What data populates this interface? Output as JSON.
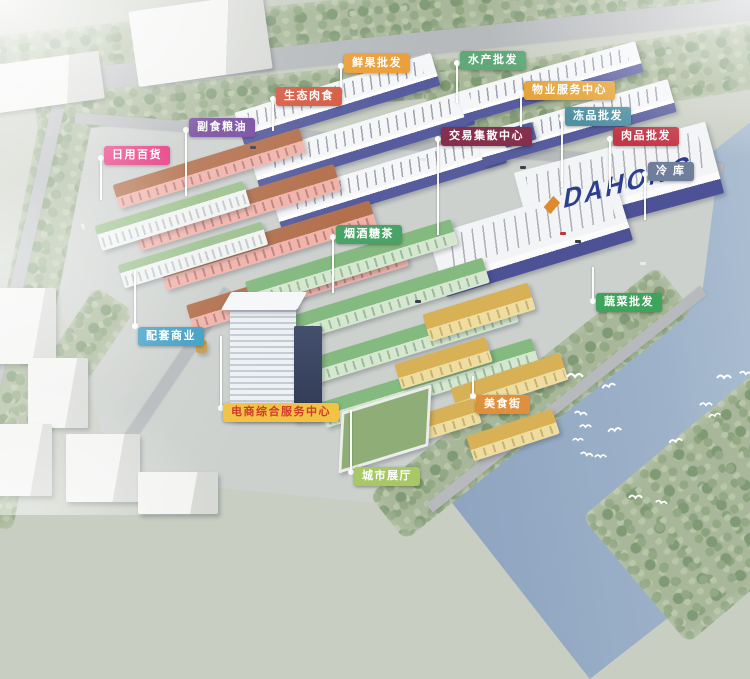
{
  "scene": {
    "type": "aerial-rendering-of-wholesale-market-masterplan",
    "roof_logo": {
      "text": "DAHONG",
      "color": "#2c3e8f",
      "accent": "#e08a2e"
    }
  },
  "labels": [
    {
      "id": "daily-goods",
      "text": "日用百货",
      "bg": "#e6327d",
      "fg": "#ffffff"
    },
    {
      "id": "grain-oil",
      "text": "副食粮油",
      "bg": "#744a9e",
      "fg": "#ffffff"
    },
    {
      "id": "eco-meat",
      "text": "生态肉食",
      "bg": "#d65a42",
      "fg": "#ffffff"
    },
    {
      "id": "fresh-fruit",
      "text": "鲜果批发",
      "bg": "#eb9f3a",
      "fg": "#ffffff"
    },
    {
      "id": "aquatic-wholesale",
      "text": "水产批发",
      "bg": "#5fa877",
      "fg": "#ffffff"
    },
    {
      "id": "trading-center",
      "text": "交易集散中心",
      "bg": "#842f4c",
      "fg": "#ffffff"
    },
    {
      "id": "property-service",
      "text": "物业服务中心",
      "bg": "#e5a53b",
      "fg": "#ffffff"
    },
    {
      "id": "frozen-wholesale",
      "text": "冻品批发",
      "bg": "#4f90a3",
      "fg": "#ffffff"
    },
    {
      "id": "meat-wholesale",
      "text": "肉品批发",
      "bg": "#c23646",
      "fg": "#ffffff"
    },
    {
      "id": "cold-storage",
      "text": "冷  库",
      "bg": "#6f7e9b",
      "fg": "#ffffff"
    },
    {
      "id": "vegetable-wholesale",
      "text": "蔬菜批发",
      "bg": "#3ea45c",
      "fg": "#ffffff"
    },
    {
      "id": "tobacco-liquor-tea",
      "text": "烟酒糖茶",
      "bg": "#4aa366",
      "fg": "#ffffff"
    },
    {
      "id": "supporting-commerce",
      "text": "配套商业",
      "bg": "#3e9fc4",
      "fg": "#ffffff"
    },
    {
      "id": "ecommerce-center",
      "text": "电商综合服务中心",
      "bg": "#f1c244",
      "fg": "#d03a2e"
    },
    {
      "id": "food-street",
      "text": "美食街",
      "bg": "#de903d",
      "fg": "#ffffff"
    },
    {
      "id": "city-exhibition-hall",
      "text": "城市展厅",
      "bg": "#a7c865",
      "fg": "#ffffff"
    }
  ],
  "palette": {
    "river": "#9db2c9",
    "land": "#cdd1ce",
    "trees": "#a8b799",
    "road": "#b7babd",
    "warehouse_wall": "#575c9e",
    "pink_retail": "#efb3aa",
    "terracotta_roof": "#b2704d",
    "green_retail": "#d6e7d0",
    "green_roof": "#84b980",
    "yellow_block": "#eedda0",
    "gold_roof": "#d8b157",
    "bird": "#ffffff"
  }
}
